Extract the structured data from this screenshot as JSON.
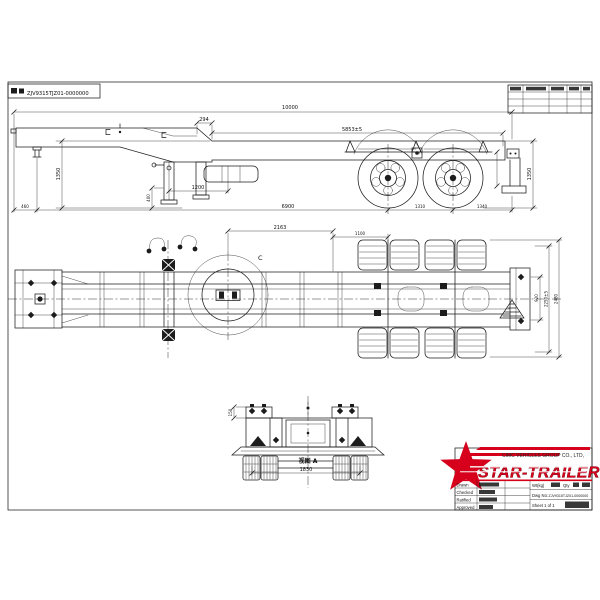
{
  "header": {
    "dwg_no": "ZJV9315TJZ01-0000000"
  },
  "side": {
    "d10000": "10000",
    "d294": "294",
    "d5853": "5853±5",
    "d1350l": "1350",
    "d1350r": "1350",
    "d460": "460",
    "d400": "400",
    "d1200": "1200",
    "d6900": "6900",
    "d1310": "1310",
    "d1340": "1340"
  },
  "plan": {
    "d2163": "2163",
    "d1100": "1100",
    "d920": "920",
    "d2250": "2250±5",
    "d2480": "2480",
    "detail": "C"
  },
  "rear": {
    "label": "视图 A",
    "d1830": "1830",
    "d150": "150"
  },
  "title_block": {
    "company": "CIMC VEHICLES GROUP CO., LTD,",
    "brand": "STAR-TRAILER",
    "rows": [
      "Drawn",
      "Checked",
      "Ratified",
      "Approved"
    ],
    "wt_label": "Wt(kg)",
    "qty_label": "Qty",
    "dwg_label": "Dwg No:",
    "dwg_no": "ZJV9315TJZ01-0000000",
    "sheet": "Sheet 1 of 1"
  },
  "colors": {
    "line": "#1c1c1c",
    "brand_red": "#d6001c"
  }
}
